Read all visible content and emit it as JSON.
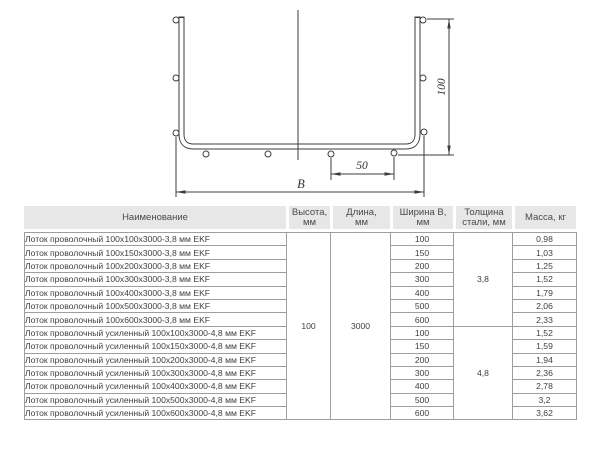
{
  "diagram": {
    "labels": {
      "height": "100",
      "spacing": "50",
      "width": "B"
    }
  },
  "table": {
    "columns": [
      "Наименование",
      "Высота,\nмм",
      "Длина,\nмм",
      "Ширина В,\nмм",
      "Толщина\nстали, мм",
      "Масса, кг"
    ],
    "merged": {
      "height": "100",
      "length": "3000",
      "thickness_standard": "3,8",
      "thickness_reinforced": "4,8"
    },
    "rows": [
      {
        "name": "Лоток проволочный 100x100x3000-3,8 мм EKF",
        "width": "100",
        "mass": "0,98"
      },
      {
        "name": "Лоток проволочный 100x150x3000-3,8 мм EKF",
        "width": "150",
        "mass": "1,03"
      },
      {
        "name": "Лоток проволочный 100x200x3000-3,8 мм EKF",
        "width": "200",
        "mass": "1,25"
      },
      {
        "name": "Лоток проволочный 100x300x3000-3,8 мм EKF",
        "width": "300",
        "mass": "1,52"
      },
      {
        "name": "Лоток проволочный 100x400x3000-3,8 мм EKF",
        "width": "400",
        "mass": "1,79"
      },
      {
        "name": "Лоток проволочный 100x500x3000-3,8 мм EKF",
        "width": "500",
        "mass": "2,06"
      },
      {
        "name": "Лоток проволочный 100x600x3000-3,8 мм EKF",
        "width": "600",
        "mass": "2,33"
      },
      {
        "name": "Лоток проволочный усиленный 100x100x3000-4,8 мм EKF",
        "width": "100",
        "mass": "1,52"
      },
      {
        "name": "Лоток проволочный усиленный 100x150x3000-4,8 мм EKF",
        "width": "150",
        "mass": "1,59"
      },
      {
        "name": "Лоток проволочный усиленный 100x200x3000-4,8 мм EKF",
        "width": "200",
        "mass": "1,94"
      },
      {
        "name": "Лоток проволочный усиленный 100x300x3000-4,8 мм EKF",
        "width": "300",
        "mass": "2,36"
      },
      {
        "name": "Лоток проволочный усиленный 100x400x3000-4,8 мм EKF",
        "width": "400",
        "mass": "2,78"
      },
      {
        "name": "Лоток проволочный усиленный 100x500x3000-4,8 мм EKF",
        "width": "500",
        "mass": "3,2"
      },
      {
        "name": "Лоток проволочный усиленный 100x600x3000-4,8 мм EKF",
        "width": "600",
        "mass": "3,62"
      }
    ]
  }
}
